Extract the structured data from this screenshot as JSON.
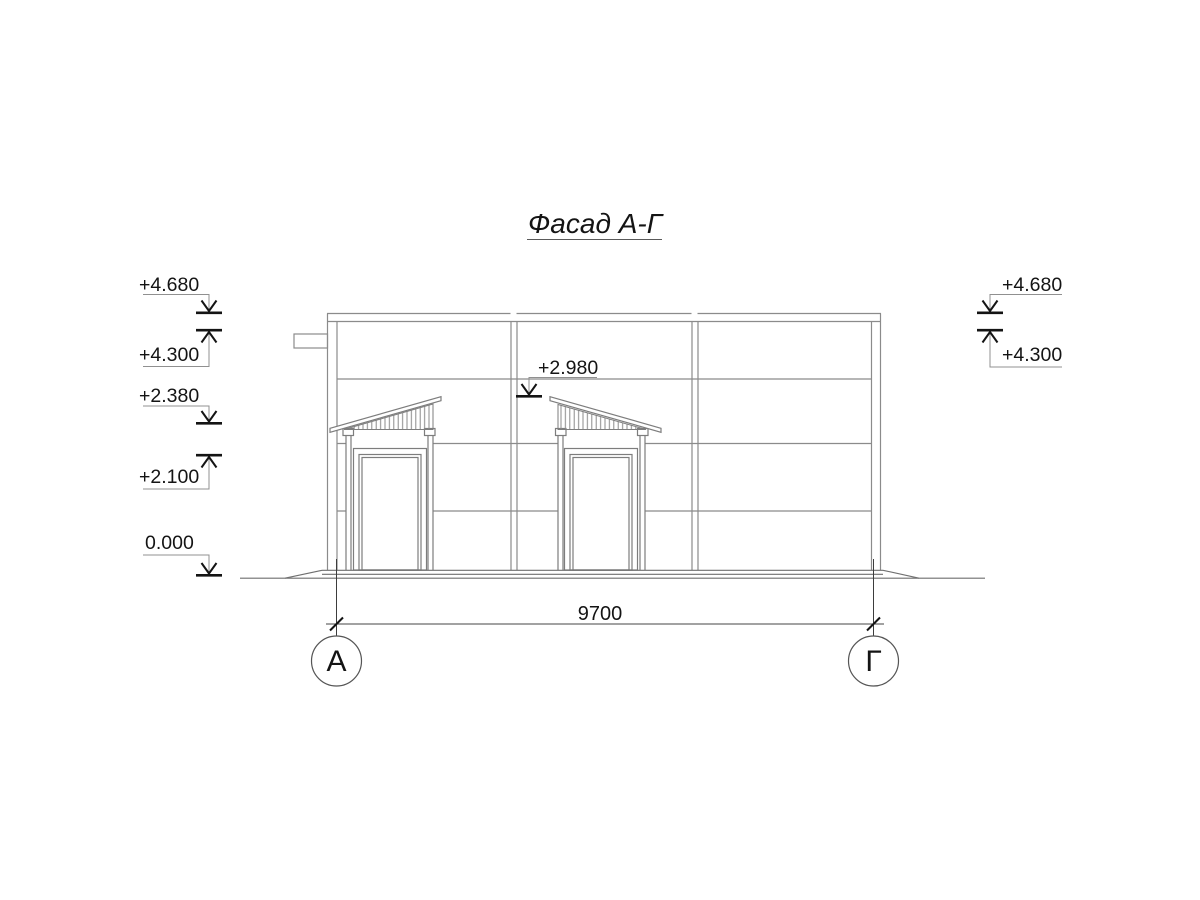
{
  "title": "Фасад А-Г",
  "levels": {
    "left": [
      "+4.680",
      "+4.300",
      "+2.380",
      "+2.100",
      "0.000"
    ],
    "right": [
      "+4.680",
      "+4.300"
    ],
    "canopy": "+2.980"
  },
  "dimension": "9700",
  "axes": {
    "left": "А",
    "right": "Г"
  },
  "colors": {
    "background": "#ffffff",
    "drawing_line": "#8b8b8b",
    "ground_line": "#6f6f6f",
    "axis_line": "#3d3d3d",
    "annotation": "#141414"
  }
}
